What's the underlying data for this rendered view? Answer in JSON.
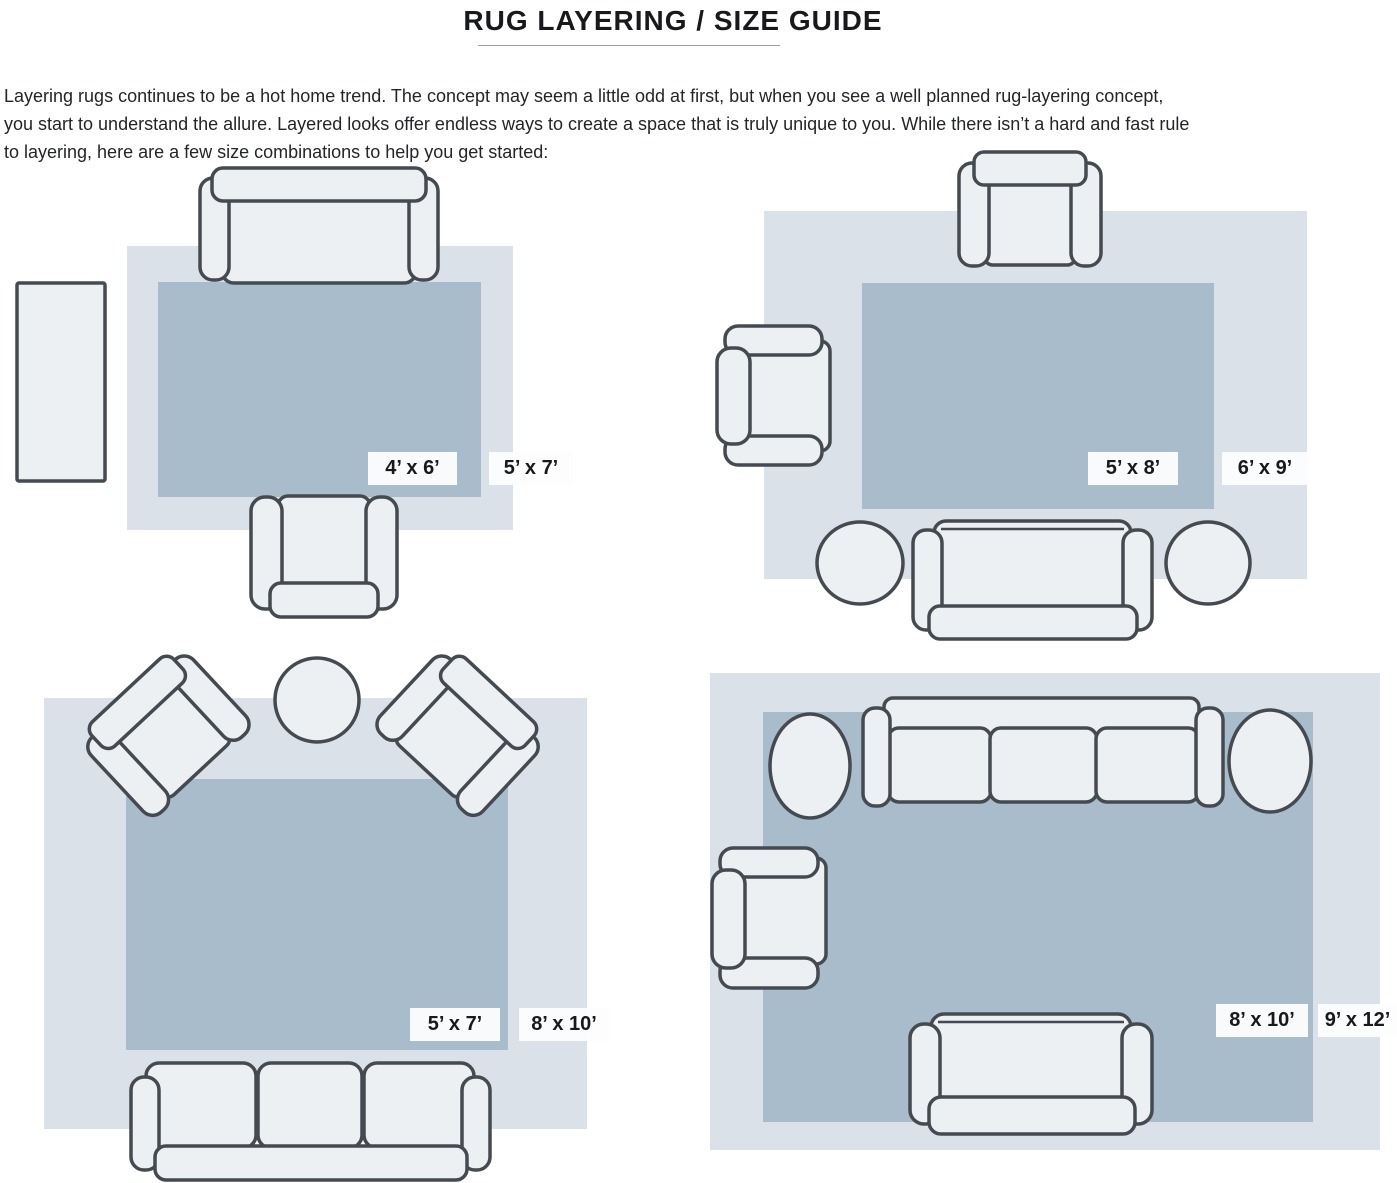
{
  "header": {
    "title": "RUG LAYERING / SIZE GUIDE"
  },
  "intro": {
    "lines": [
      "Layering rugs continues to be a hot home trend. The concept may seem a little odd at first, but when you see a well planned rug-layering concept,",
      "you start to understand the allure. Layered looks offer endless ways to create a space that is truly unique to you. While there isn’t a hard and fast rule",
      "to layering, here are a few size combinations to help you get started:"
    ]
  },
  "colors": {
    "large_rug": "#dbe1e9",
    "small_rug": "#a8bccc",
    "furniture_fill": "#edf0f3",
    "furniture_outline": "#454a51",
    "label_background": "#fdfdfe",
    "label_text": "#17191c"
  },
  "diagrams": [
    {
      "id": "top-left",
      "small_rug_label": "4’ x 6’",
      "large_rug_label": "5’ x 7’"
    },
    {
      "id": "top-right",
      "small_rug_label": "5’ x 8’",
      "large_rug_label": "6’ x 9’"
    },
    {
      "id": "bottom-left",
      "small_rug_label": "5’ x 7’",
      "large_rug_label": "8’ x 10’"
    },
    {
      "id": "bottom-right",
      "small_rug_label": "8’ x 10’",
      "large_rug_label": "9’ x 12’"
    }
  ]
}
